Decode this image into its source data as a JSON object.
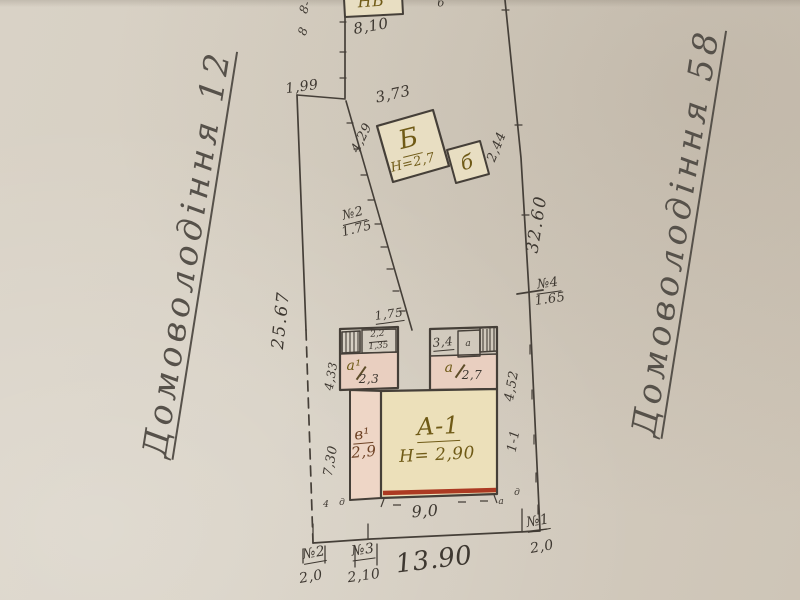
{
  "margins": {
    "left_note": "Домоволодіння 12",
    "right_note": "Домоволодіння 58"
  },
  "plot": {
    "boundary": {
      "left": "25.67",
      "right": "32.60",
      "bottom": "13.90",
      "top_offset": "1,99",
      "top_edge_a": "8-",
      "top_edge_b": "8"
    },
    "gates": [
      {
        "id": "№1",
        "size": "2,0"
      },
      {
        "id": "№2",
        "size": "2,0"
      },
      {
        "id": "№3",
        "size": "2,10"
      },
      {
        "id": "№4",
        "size": "1.65"
      }
    ],
    "fence": {
      "id": "№2",
      "length": "1.75",
      "offset": "1,75"
    }
  },
  "buildings": {
    "nb": {
      "label": "НБ",
      "width": "8,10",
      "mark": "б"
    },
    "b": {
      "label": "Б",
      "height": "Н=2,7",
      "annex": "б",
      "dim_top": "3,73",
      "dim_left": "4,29",
      "dim_right": "2,44"
    },
    "house": {
      "label": "А-1",
      "height": "Н= 2,90",
      "room_left": "в¹",
      "room_left_area": "2,9",
      "annex_left": "а¹",
      "annex_left_area": "2,3",
      "annex_right": "а",
      "annex_right_area": "2,7",
      "porch_width": "2,2",
      "porch_length": "1,35",
      "porch_mark": "а",
      "dim_width": "3,4",
      "dim_bottom": "9,0",
      "dim_left_upper": "4,33",
      "dim_left_lower": "7,30",
      "dim_right_side": "4,52",
      "section_mark": "1-1"
    },
    "points": {
      "p1": "4",
      "p2": "д",
      "p3": "а",
      "p4": "д"
    }
  }
}
